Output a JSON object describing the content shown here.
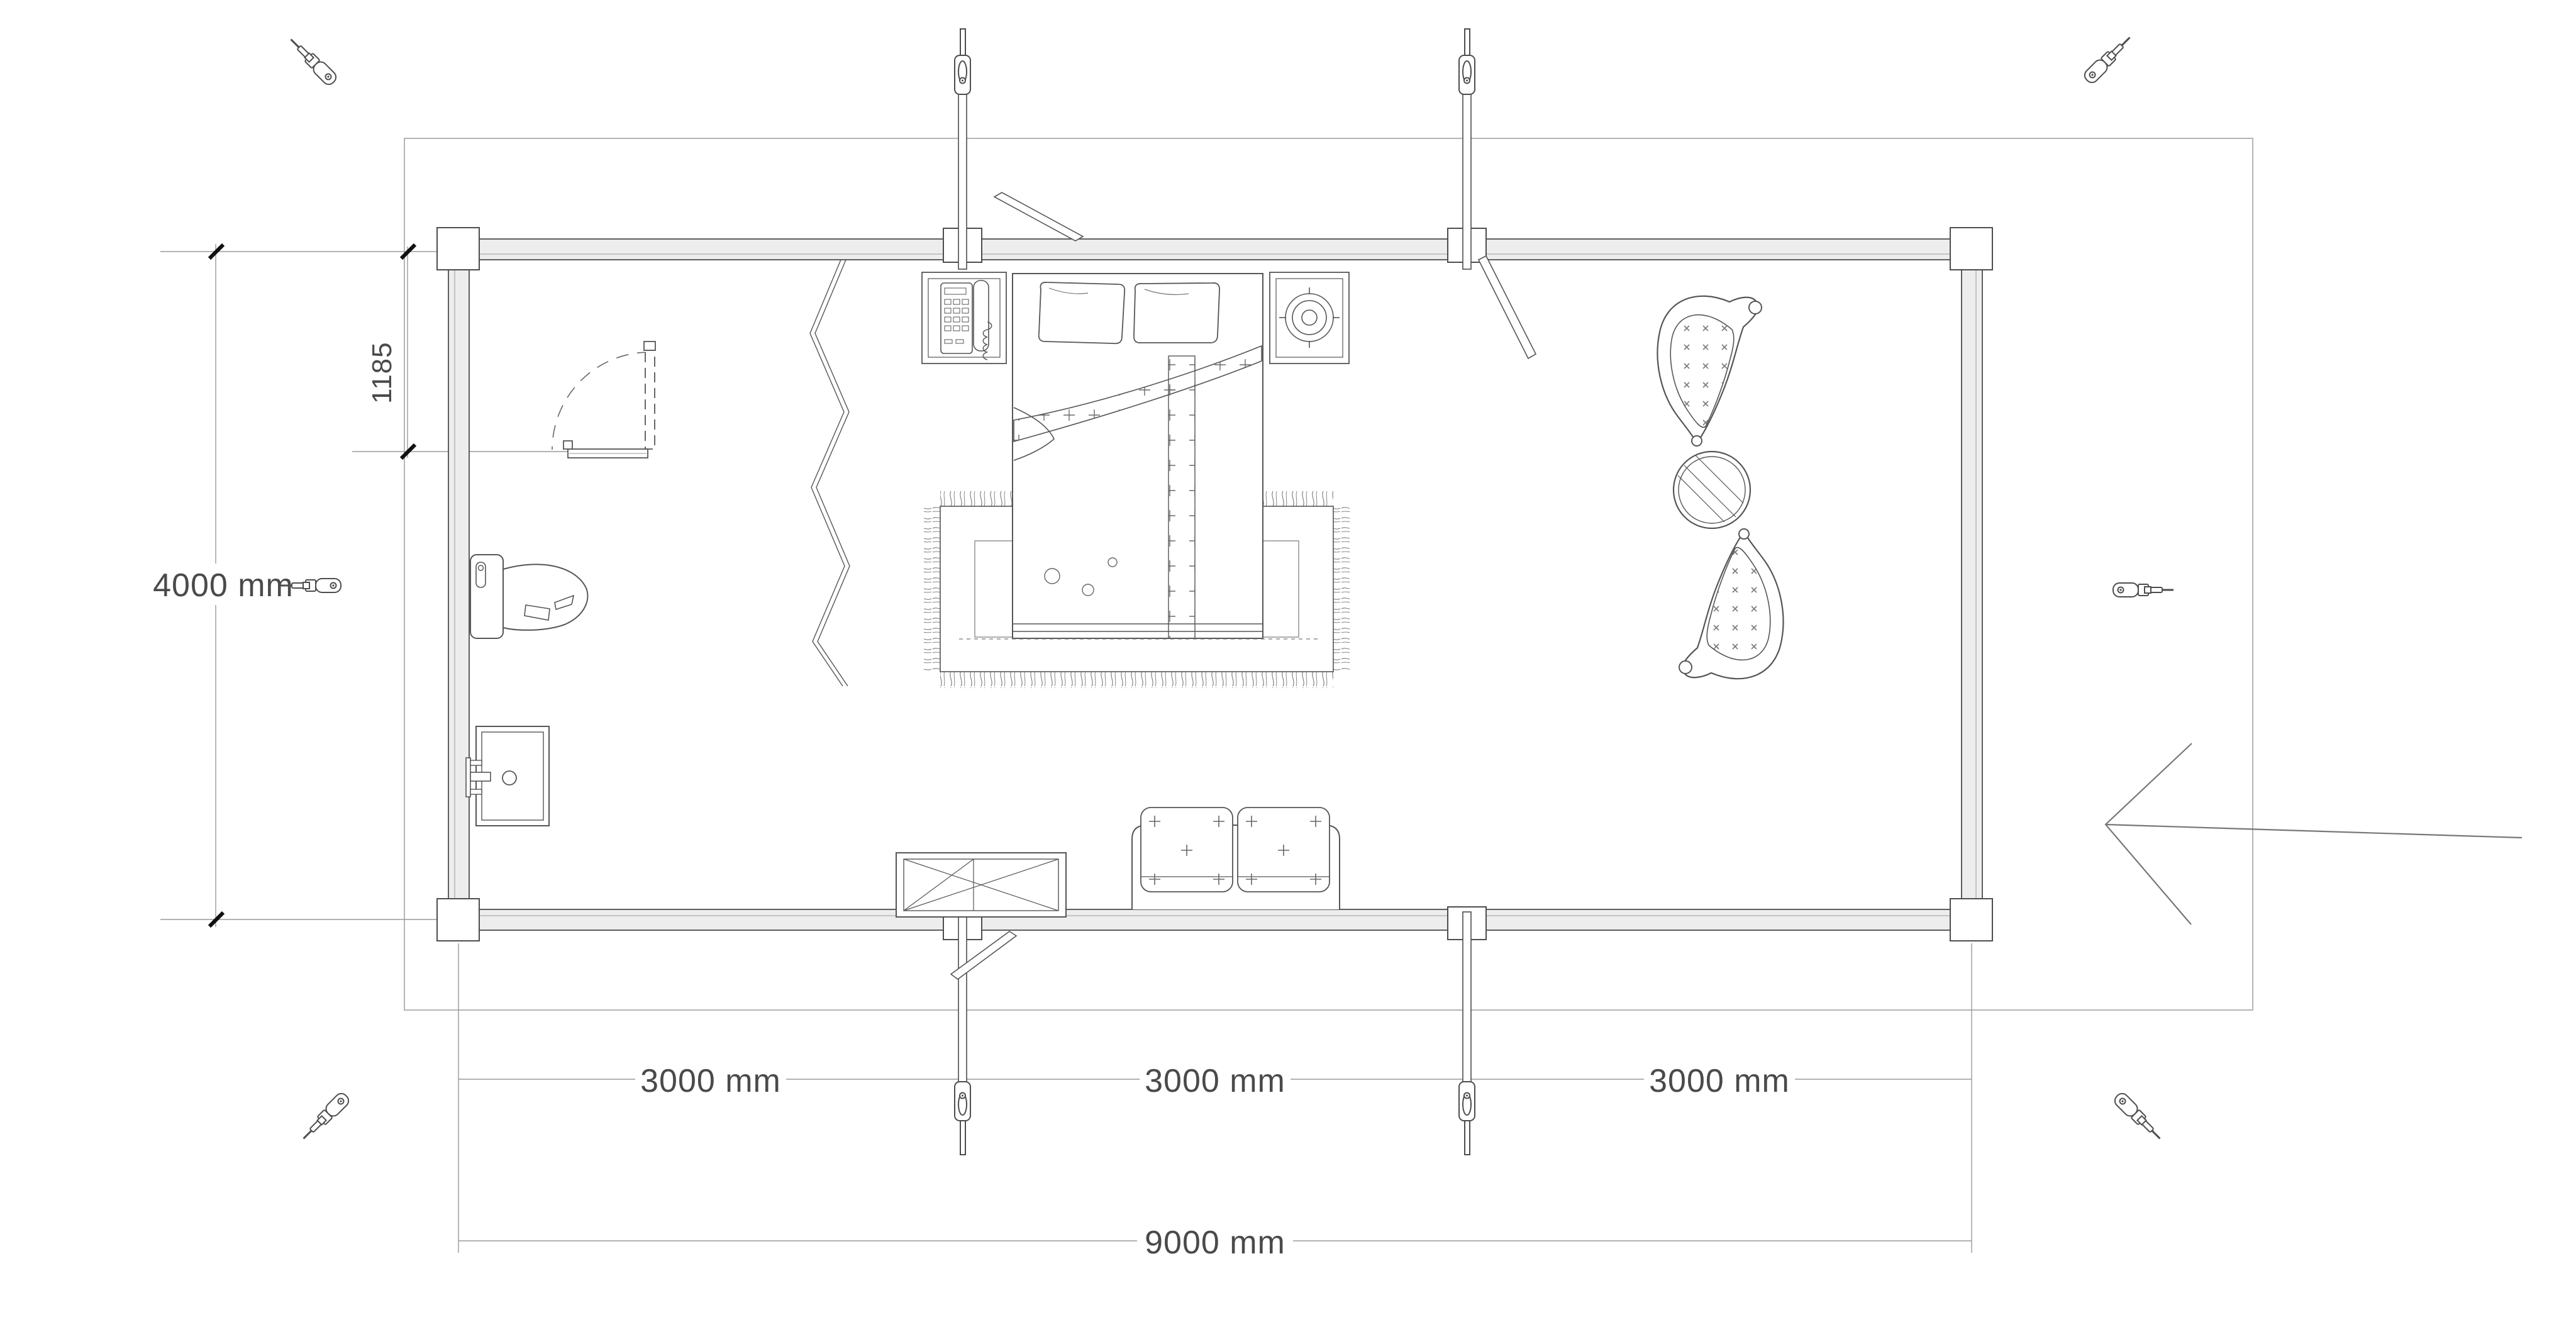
{
  "plan": {
    "type": "floor-plan",
    "unit": "mm",
    "labels": {
      "total_width": "9000 mm",
      "total_depth": "4000 mm",
      "bay1": "3000 mm",
      "bay2": "3000 mm",
      "bay3": "3000 mm",
      "door_offset": "1185"
    },
    "colors": {
      "line": "#4d4d4d",
      "dim_line": "#9a9a9a",
      "text": "#4a4a4a",
      "wall_fill": "#ededed",
      "boundary": "#b5b5b5",
      "tick": "#111111"
    },
    "icons": {
      "corner_fastener": "screwdriver-icon",
      "wall_brace": "turnbuckle-pole-icon",
      "entrance": "entrance-arrow-icon"
    },
    "furniture": [
      "double-bed",
      "pillow",
      "pillow",
      "area-rug",
      "folding-screen",
      "nightstand-telephone",
      "nightstand-burner",
      "toilet",
      "washbasin",
      "bathroom-door",
      "tv-cabinet",
      "two-seat-sofa",
      "lounge-chair",
      "lounge-chair",
      "round-glass-table",
      "leaning-plank"
    ]
  }
}
